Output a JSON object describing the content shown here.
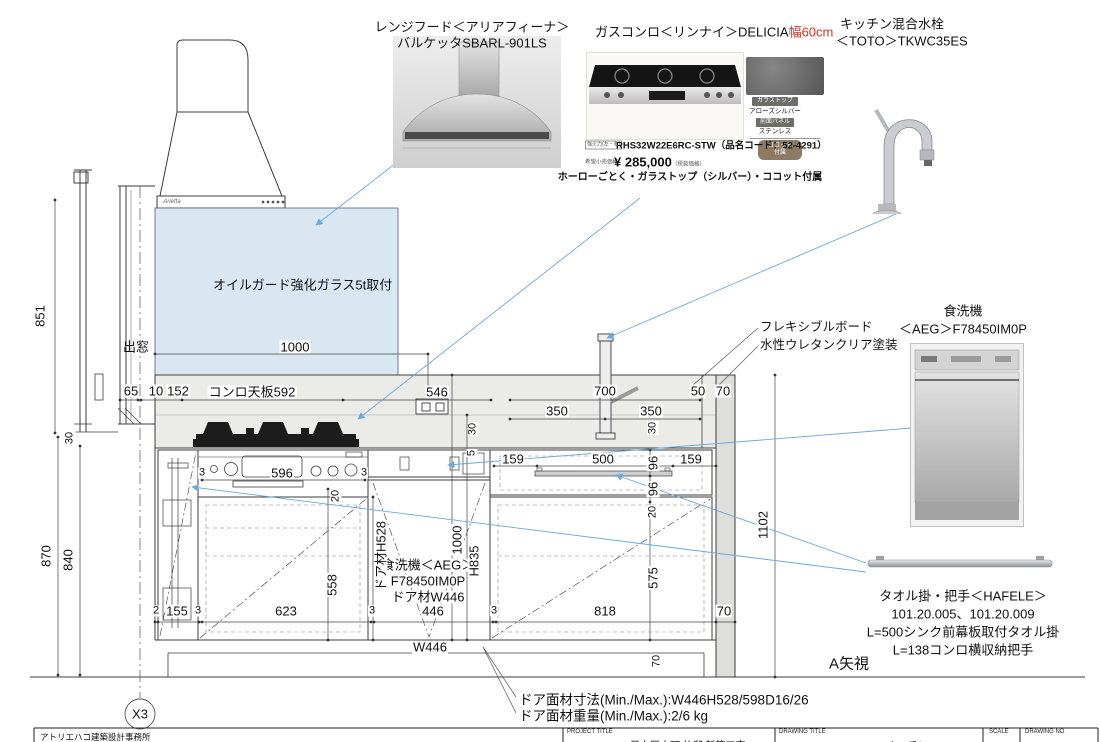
{
  "products": {
    "range_hood": {
      "label_line1": "レンジフード＜アリアフィーナ＞",
      "label_line2": "バルケッタSBARL-901LS",
      "brand_mark": "Arietta"
    },
    "gas_stove": {
      "label": "ガスコンロ＜リンナイ＞DELICIA",
      "width_note": "幅60cm",
      "power_note": "強火力(左・右)",
      "model": "RHS32W22E6RC-STW（品名コード：52-4291）",
      "price_prefix": "希望小売価格",
      "price": "¥ 285,000",
      "price_note": "（税抜価格）",
      "spec": "ホーローごとく・ガラストップ（シルバー）・ココット付属",
      "swatch_badge_top": "ガラストップ",
      "swatch_top_value": "アローズシルバー",
      "swatch_badge_panel": "前面パネル",
      "swatch_panel_value": "ステンレス",
      "cocotte_badge_line1": "ココット",
      "cocotte_badge_line2": "付属"
    },
    "faucet": {
      "label_line1": "キッチン混合水栓",
      "label_line2": "＜TOTO＞TKWC35ES"
    },
    "dishwasher": {
      "label_line1": "食洗機",
      "label_line2": "＜AEG＞F78450IM0P"
    },
    "towel_bar": {
      "line1": "タオル掛・把手＜HAFELE＞",
      "line2": "101.20.005、101.20.009",
      "line3": "L=500シンク前幕板取付タオル掛",
      "line4": "L=138コンロ横収納把手"
    }
  },
  "annotations": {
    "oil_guard": "オイルガード強化ガラス5t取付",
    "flex_board_line1": "フレキシブルボード",
    "flex_board_line2": "水性ウレタンクリア塗装",
    "bay_window": "出窓",
    "counter_label": "コンロ天板592",
    "dw_note_line1": "食洗機＜AEG＞",
    "dw_note_line2": "F78450IM0P",
    "dw_note_line3": "ドア材W446",
    "view_label": "A矢視",
    "door_size_note": "ドア面材寸法(Min./Max.):W446H528/598D16/26",
    "door_weight_note": "ドア面材重量(Min./Max.):2/6 kg",
    "grid_label": "X3"
  },
  "dimensions": {
    "d851": "851",
    "d870": "870",
    "d840": "840",
    "d30_win": "30",
    "d65": "65",
    "d10": "10",
    "d152": "152",
    "d1000_top": "1000",
    "d546": "546",
    "d700": "700",
    "d350_l": "350",
    "d350_r": "350",
    "d50": "50",
    "d70_top": "70",
    "d30_a": "30",
    "d30_b": "30",
    "d5": "5",
    "d159_l": "159",
    "d500": "500",
    "d159_r": "159",
    "d96_a": "96",
    "d96_b": "96",
    "d20_a": "20",
    "d575": "575",
    "d3_a": "3",
    "d596": "596",
    "d3_b": "3",
    "d20_b": "20",
    "d558": "558",
    "dH528": "ドア材H528",
    "d1000_b": "1000",
    "dH835": "H835",
    "d2": "2",
    "d155": "155",
    "d3_c": "3",
    "d623": "623",
    "d3_d": "3",
    "d446": "446",
    "d3_e": "3",
    "d818": "818",
    "d70_r": "70",
    "dW446": "W446",
    "d1102": "1102",
    "d70_b": "70"
  },
  "title_block": {
    "firm": "アトリエハコ建築設計事務所",
    "project_label": "PROJECT TITLE",
    "project_value": "目白区本町 仲邸 新築工事",
    "drawing_label": "DRAWING TITLE",
    "drawing_value": "キッチン04",
    "scale_label": "SCALE",
    "drawing_no_label": "DRAWING NO"
  },
  "colors": {
    "accent_blue": "#6aa9dd",
    "glass_blue": "#dae7f3",
    "red": "#e03020"
  }
}
